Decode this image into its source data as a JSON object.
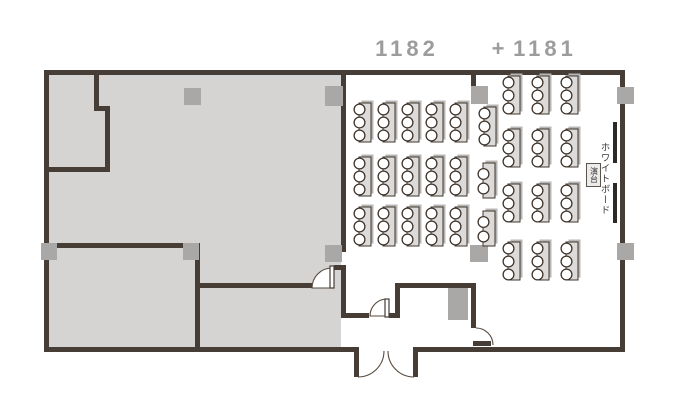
{
  "header": {
    "room_left": "1182",
    "separator": "+",
    "room_right": "1181"
  },
  "fixtures": {
    "whiteboard_label": "ホワイトボード",
    "lectern_label": "演台"
  },
  "colors": {
    "wall": "#463d36",
    "gray_room_fill": "#d5d4d2",
    "pillar": "#a9a8a6",
    "table_fill": "#dcdbd9",
    "table_border": "#3f352d",
    "chair_fill": "#ffffff",
    "whiteboard": "#2e2925",
    "title_text": "#9c9c9c"
  },
  "furniture": {
    "chair_radius": 5.4,
    "table_groups": [
      {
        "name": "room-1182-tables",
        "cols_x": [
          359,
          383,
          407,
          431,
          455
        ],
        "rows_y": [
          103,
          157,
          207
        ],
        "table_w": 12,
        "table_h": 39,
        "chairs_per_table": 3
      },
      {
        "name": "room-1181-tables",
        "cols_x": [
          508,
          537,
          566
        ],
        "rows_y": [
          76,
          129,
          184,
          242
        ],
        "table_w": 12,
        "table_h": 38,
        "chairs_per_table": 3
      }
    ],
    "single_tables": [
      {
        "x": 484,
        "y": 107,
        "w": 12,
        "h": 39,
        "chairs": 3
      },
      {
        "x": 483,
        "y": 163,
        "w": 12,
        "h": 35,
        "chairs": 2
      },
      {
        "x": 483,
        "y": 211,
        "w": 12,
        "h": 35,
        "chairs": 2
      }
    ]
  },
  "pillars": [
    {
      "name": "pillar-gray-room-top",
      "x": 184,
      "y": 88,
      "w": 17,
      "h": 17
    },
    {
      "name": "pillar-gray-room-top-right",
      "x": 325,
      "y": 86,
      "w": 18,
      "h": 20
    },
    {
      "name": "pillar-partition-top",
      "x": 471,
      "y": 86,
      "w": 17,
      "h": 18
    },
    {
      "name": "pillar-right-wall-top",
      "x": 617,
      "y": 87,
      "w": 17,
      "h": 17
    },
    {
      "name": "pillar-left-wall",
      "x": 41,
      "y": 243,
      "w": 16,
      "h": 17
    },
    {
      "name": "pillar-interior-wall-end",
      "x": 183,
      "y": 243,
      "w": 16,
      "h": 17
    },
    {
      "name": "pillar-gray-room-bottom-right",
      "x": 325,
      "y": 245,
      "w": 17,
      "h": 17
    },
    {
      "name": "pillar-partition-bottom",
      "x": 470,
      "y": 245,
      "w": 18,
      "h": 17
    },
    {
      "name": "pillar-right-wall-bottom",
      "x": 617,
      "y": 243,
      "w": 17,
      "h": 17
    },
    {
      "name": "pillar-vestibule",
      "x": 448,
      "y": 288,
      "w": 20,
      "h": 32
    }
  ]
}
